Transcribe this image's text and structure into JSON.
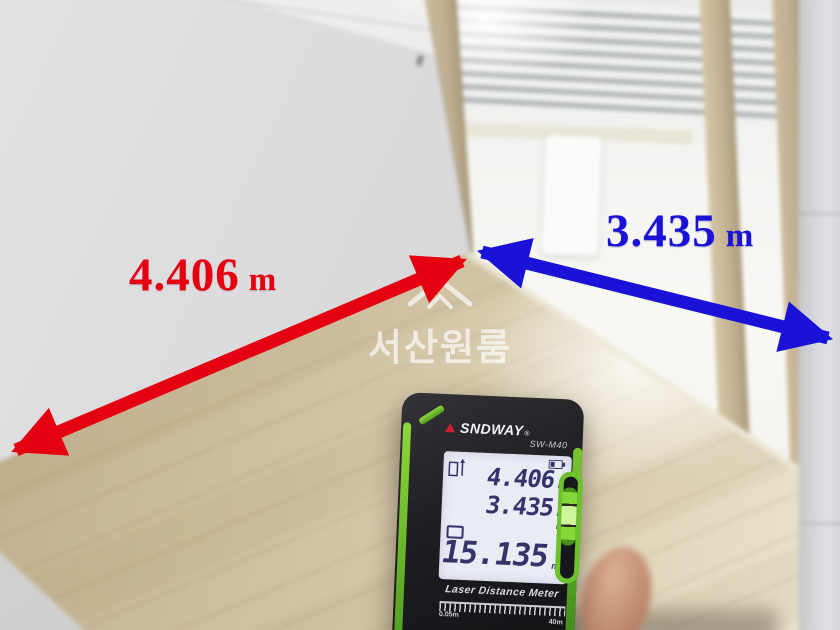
{
  "watermark": {
    "text": "서산원룸"
  },
  "measurements": {
    "red": {
      "value": "4.406",
      "unit": "m"
    },
    "blue": {
      "value": "3.435",
      "unit": "m"
    }
  },
  "device": {
    "brand": "SNDWAY",
    "trademark": "®",
    "model": "SW-M40",
    "screen": {
      "readings": [
        {
          "value": "4.406",
          "unit": "m"
        },
        {
          "value": "3.435",
          "unit": "m"
        },
        {
          "value": "",
          "unit": "m"
        },
        {
          "value": "15.135",
          "unit": "m²"
        }
      ]
    },
    "caption": "Laser Distance Meter",
    "range_min": "0.05m",
    "range_max": "40m"
  },
  "colors": {
    "red_annotation": "#e50011",
    "blue_annotation": "#1b12d7",
    "device_green": "#7fd231",
    "lcd_digits": "#34346b"
  }
}
